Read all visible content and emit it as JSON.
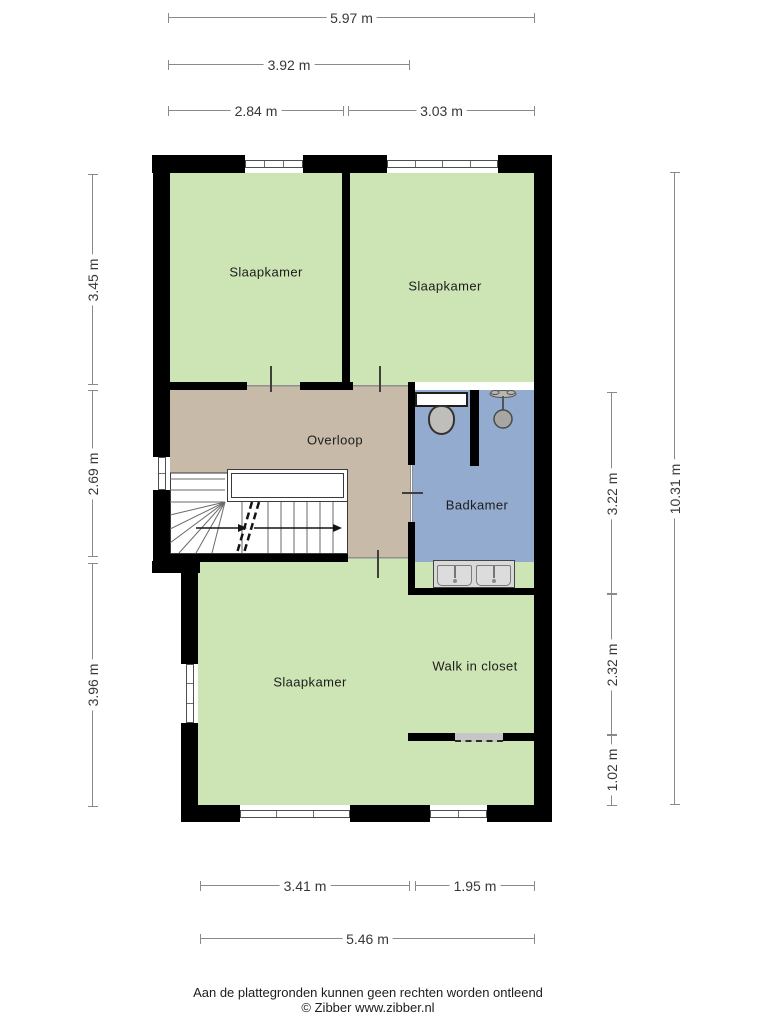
{
  "rooms": {
    "bedroom1": {
      "label": "Slaapkamer"
    },
    "bedroom2": {
      "label": "Slaapkamer"
    },
    "bedroom3": {
      "label": "Slaapkamer"
    },
    "landing": {
      "label": "Overloop"
    },
    "bathroom": {
      "label": "Badkamer"
    },
    "closet": {
      "label": "Walk in closet"
    }
  },
  "dimensions": {
    "top": [
      {
        "label": "5.97 m"
      },
      {
        "label": "3.92 m"
      },
      {
        "label": "2.84 m"
      },
      {
        "label": "3.03 m"
      }
    ],
    "left": [
      {
        "label": "3.45 m"
      },
      {
        "label": "2.69 m"
      },
      {
        "label": "3.96 m"
      }
    ],
    "right": [
      {
        "label": "3.22 m"
      },
      {
        "label": "2.32 m"
      },
      {
        "label": "1.02 m"
      },
      {
        "label": "10.31 m"
      }
    ],
    "bottom": [
      {
        "label": "3.41 m"
      },
      {
        "label": "1.95 m"
      },
      {
        "label": "5.46 m"
      }
    ]
  },
  "footer": {
    "disclaimer": "Aan de plattegronden kunnen geen rechten worden ontleend",
    "copyright": "© Zibber www.zibber.nl"
  },
  "colors": {
    "room_green": "#cde4b4",
    "landing_tan": "#c8baa9",
    "bathroom_blue": "#92abce",
    "closet_gray": "#d2d2d2",
    "wall_black": "#000000",
    "dim_line": "#8a8a8a"
  }
}
